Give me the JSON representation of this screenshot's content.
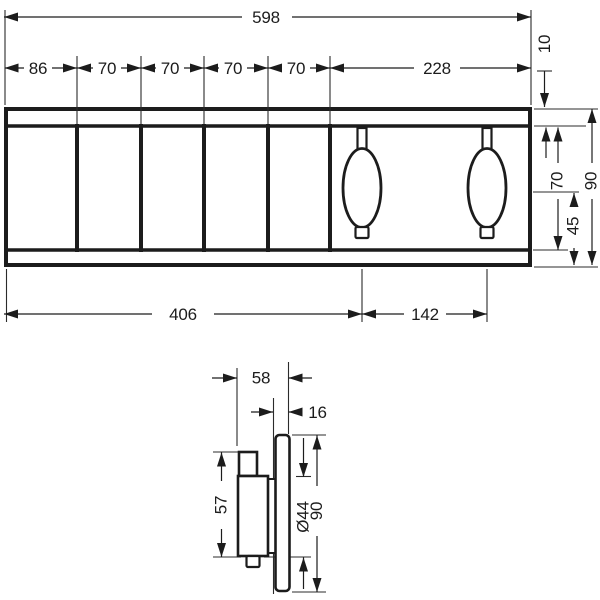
{
  "drawing_title": "Thermostat trim technical dimension drawing",
  "ink_color": "#1c1c1c",
  "front_view": {
    "total_width": "598",
    "segment_widths": [
      "86",
      "70",
      "70",
      "70",
      "70",
      "228"
    ],
    "top_offset": "10",
    "inner_height": "70",
    "total_height": "90",
    "center_to_bottom": "45",
    "left_to_handle1": "406",
    "handle_spacing": "142"
  },
  "side_view": {
    "total_depth": "58",
    "plate_depth": "16",
    "handle_height": "57",
    "handle_diameter": "Ø44",
    "plate_height": "90"
  }
}
